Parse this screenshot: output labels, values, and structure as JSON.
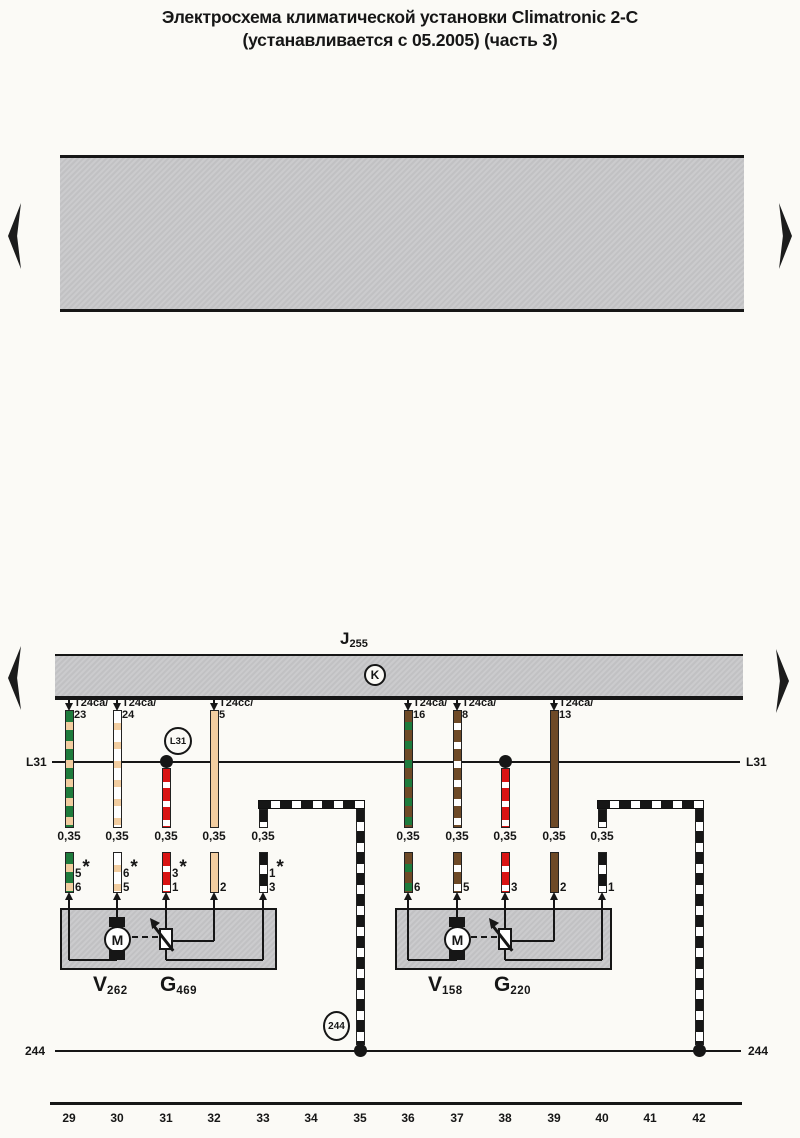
{
  "title": {
    "line1": "Электросхема климатической установки Climatronic 2-C",
    "line2": "(устанавливается с 05.2005) (часть 3)"
  },
  "bus": {
    "name": "J",
    "sub": "255",
    "hub": "K"
  },
  "rails": {
    "l31": {
      "left": "L31",
      "right": "L31",
      "junction": "L31"
    },
    "r244": {
      "left": "244",
      "right": "244",
      "junction": "244"
    }
  },
  "wires": [
    {
      "id": "w29",
      "track": 29,
      "color": "green-beige",
      "connector": {
        "t": "T24ca/",
        "p": "23"
      },
      "gauge": "0,35",
      "pins": [
        {
          "n": "5",
          "star": "*"
        },
        {
          "n": "6"
        }
      ]
    },
    {
      "id": "w30",
      "track": 30,
      "color": "white-beige",
      "connector": {
        "t": "T24ca/",
        "p": "24"
      },
      "gauge": "0,35",
      "pins": [
        {
          "n": "6",
          "star": "*"
        },
        {
          "n": "5"
        }
      ]
    },
    {
      "id": "w31",
      "track": 31,
      "color": "red-white",
      "gauge": "0,35",
      "pins": [
        {
          "n": "3",
          "star": "*"
        },
        {
          "n": "1"
        }
      ]
    },
    {
      "id": "w32",
      "track": 32,
      "color": "beige",
      "connector": {
        "t": "T24cc/",
        "p": "5"
      },
      "gauge": "0,35",
      "pins": [
        {
          "n": "2"
        }
      ]
    },
    {
      "id": "w33",
      "track": 33,
      "color": "black-white",
      "gauge": "0,35",
      "pins": [
        {
          "n": "1",
          "star": "*"
        },
        {
          "n": "3"
        }
      ]
    },
    {
      "id": "w35",
      "track": 35,
      "color": "black-white"
    },
    {
      "id": "w36",
      "track": 36,
      "color": "brown-green",
      "connector": {
        "t": "T24ca/",
        "p": "16"
      },
      "gauge": "0,35",
      "pins": [
        {
          "n": "6"
        }
      ]
    },
    {
      "id": "w37",
      "track": 37,
      "color": "brown-white",
      "connector": {
        "t": "T24ca/",
        "p": "8"
      },
      "gauge": "0,35",
      "pins": [
        {
          "n": "5"
        }
      ]
    },
    {
      "id": "w38",
      "track": 38,
      "color": "red-white",
      "gauge": "0,35",
      "pins": [
        {
          "n": "3"
        }
      ]
    },
    {
      "id": "w39",
      "track": 39,
      "color": "brown",
      "connector": {
        "t": "T24ca/",
        "p": "13"
      },
      "gauge": "0,35",
      "pins": [
        {
          "n": "2"
        }
      ]
    },
    {
      "id": "w40",
      "track": 40,
      "color": "black-white",
      "gauge": "0,35",
      "pins": [
        {
          "n": "1"
        }
      ]
    },
    {
      "id": "w42",
      "track": 42,
      "color": "black-white"
    }
  ],
  "components": [
    {
      "id": "left-actuator",
      "motor": "M",
      "labels": [
        {
          "main": "V",
          "sub": "262"
        },
        {
          "main": "G",
          "sub": "469"
        }
      ]
    },
    {
      "id": "right-actuator",
      "motor": "M",
      "labels": [
        {
          "main": "V",
          "sub": "158"
        },
        {
          "main": "G",
          "sub": "220"
        }
      ]
    }
  ],
  "tracks": [
    "29",
    "30",
    "31",
    "32",
    "33",
    "34",
    "35",
    "36",
    "37",
    "38",
    "39",
    "40",
    "41",
    "42"
  ],
  "colors": {
    "green": "#1e7b3c",
    "beige": "#f2cda0",
    "red": "#d91414",
    "brown": "#6e4a27",
    "black": "#161616",
    "white": "#ffffff",
    "line": "#161616",
    "panel": "#c8c8ca"
  }
}
